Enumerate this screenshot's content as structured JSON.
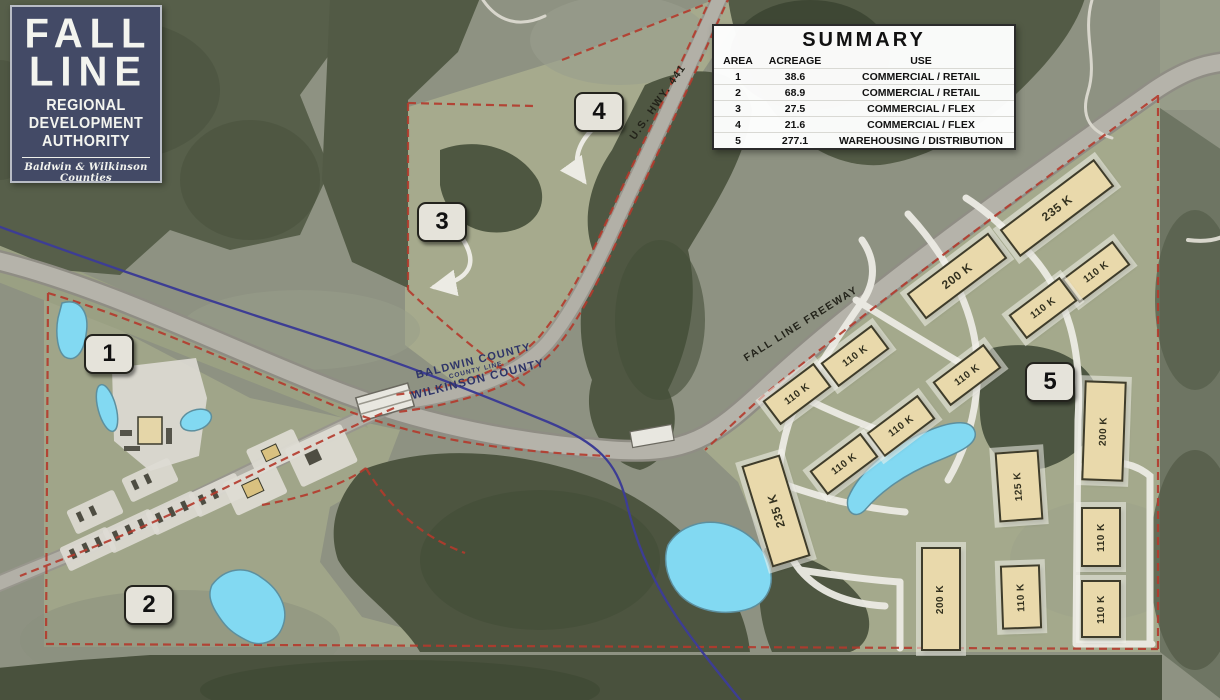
{
  "logo": {
    "lines": [
      "FALL",
      "LINE"
    ],
    "org": [
      "REGIONAL",
      "DEVELOPMENT",
      "AUTHORITY"
    ],
    "tagline": "Baldwin & Wilkinson Counties"
  },
  "summary": {
    "title": "SUMMARY",
    "columns": [
      "AREA",
      "ACREAGE",
      "USE"
    ],
    "rows": [
      [
        "1",
        "38.6",
        "COMMERCIAL / RETAIL"
      ],
      [
        "2",
        "68.9",
        "COMMERCIAL / RETAIL"
      ],
      [
        "3",
        "27.5",
        "COMMERCIAL / FLEX"
      ],
      [
        "4",
        "21.6",
        "COMMERCIAL / FLEX"
      ],
      [
        "5",
        "277.1",
        "WAREHOUSING / DISTRIBUTION"
      ]
    ]
  },
  "road_labels": {
    "hwy441": "U.S. HWY. 441",
    "freeway": "FALL LINE FREEWAY"
  },
  "county_line": {
    "top": "BALDWIN COUNTY",
    "middle": "COUNTY LINE",
    "bottom": "WILKINSON COUNTY"
  },
  "area_badges": [
    {
      "num": "1"
    },
    {
      "num": "2"
    },
    {
      "num": "3"
    },
    {
      "num": "4"
    },
    {
      "num": "5"
    }
  ],
  "buildings": [
    {
      "label": "235 K"
    },
    {
      "label": "200 K"
    },
    {
      "label": "110 K"
    },
    {
      "label": "110 K"
    },
    {
      "label": "110 K"
    },
    {
      "label": "110 K"
    },
    {
      "label": "110 K"
    },
    {
      "label": "110 K"
    },
    {
      "label": "110 K"
    },
    {
      "label": "235 K"
    },
    {
      "label": "125 K"
    },
    {
      "label": "200 K"
    },
    {
      "label": "110 K"
    },
    {
      "label": "110 K"
    },
    {
      "label": "200 K"
    },
    {
      "label": "110 K"
    }
  ],
  "colors": {
    "boundary_red": "#b43a2c",
    "county_line_blue": "#3d3d94",
    "pond_blue": "#82d9f2",
    "building_tan": "#e9d9ab",
    "logo_navy": "#434a66"
  }
}
